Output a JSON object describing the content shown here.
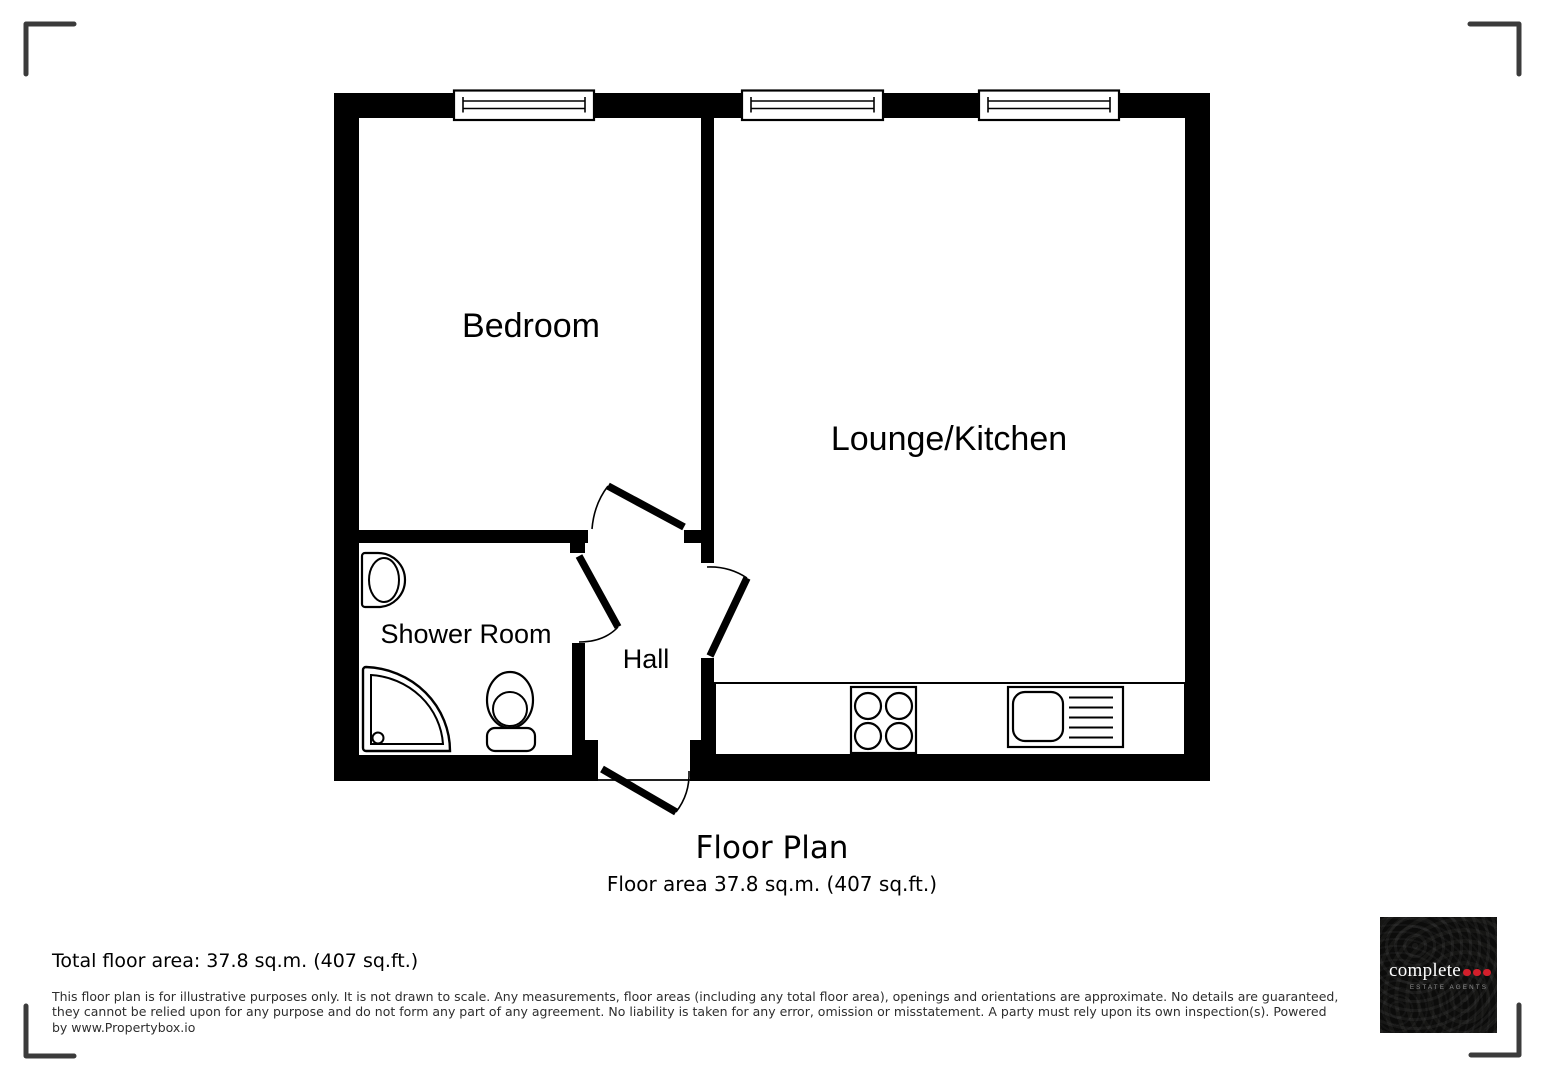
{
  "plan": {
    "title": "Floor Plan",
    "subtitle": "Floor area 37.8 sq.m. (407 sq.ft.)",
    "rooms": [
      {
        "id": "bedroom",
        "label": "Bedroom"
      },
      {
        "id": "lounge-kitchen",
        "label": "Lounge/Kitchen"
      },
      {
        "id": "shower-room",
        "label": "Shower Room"
      },
      {
        "id": "hall",
        "label": "Hall"
      }
    ],
    "fixtures": [
      "window",
      "door-swing",
      "kitchen-counter",
      "hob",
      "sink-with-drainer",
      "wash-basin",
      "shower-tray",
      "toilet"
    ],
    "wall_color": "#000000",
    "corner_mark_color": "#3b3b3b"
  },
  "footer": {
    "total_area": "Total floor area: 37.8 sq.m. (407 sq.ft.)",
    "disclaimer_lines": [
      "This floor plan is for illustrative purposes only. It is not drawn to scale. Any measurements, floor areas (including any total floor area), openings and orientations are approximate. No details are guaranteed,",
      "they cannot be relied upon for any purpose and do not form any part of any agreement. No liability is taken for any error, omission or misstatement. A party must rely upon its own inspection(s). Powered",
      "by www.Propertybox.io"
    ]
  },
  "logo": {
    "brand": "complete",
    "tagline": "ESTATE AGENTS",
    "dot_count": 3,
    "dot_color": "#d21f2b",
    "bg_color": "#0c0c0b"
  }
}
